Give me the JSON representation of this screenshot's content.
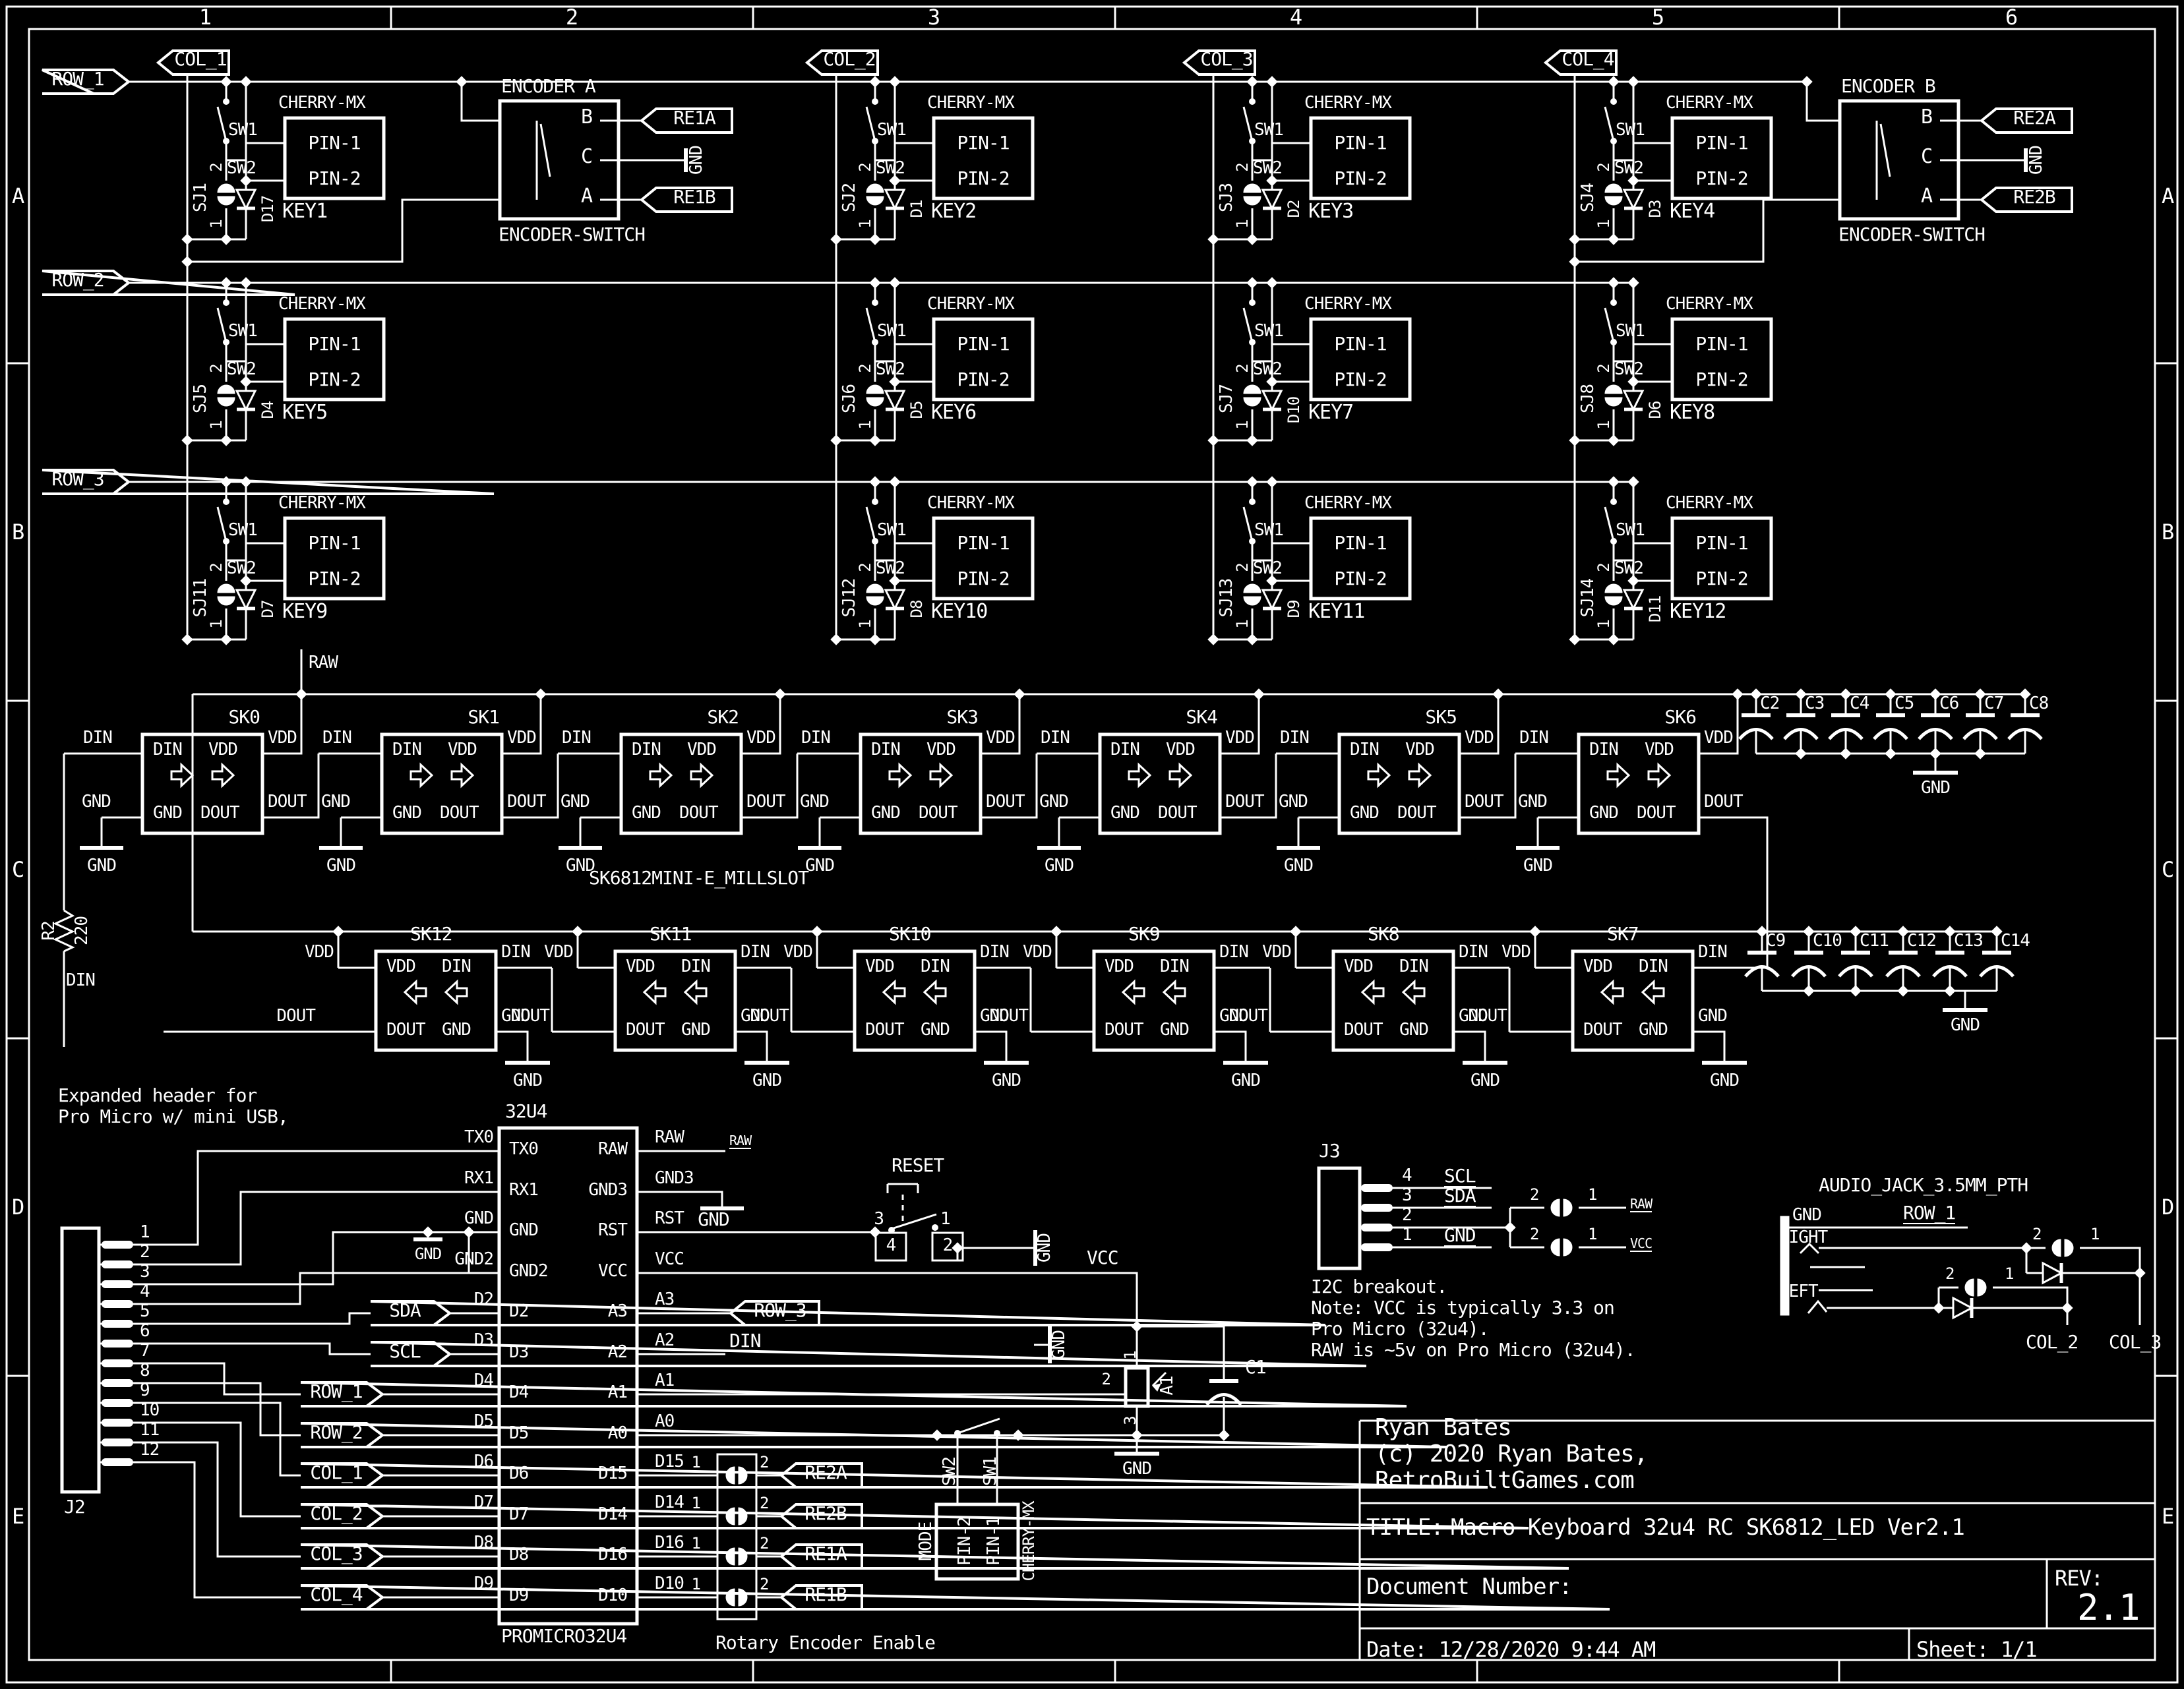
{
  "sheet": {
    "cols": [
      "1",
      "2",
      "3",
      "4",
      "5",
      "6"
    ],
    "rows": [
      "A",
      "B",
      "C",
      "D",
      "E"
    ]
  },
  "title_block": {
    "owner": [
      "Ryan Bates",
      "(c) 2020 Ryan Bates,",
      "RetroBuiltGames.com"
    ],
    "title_label": "TITLE:",
    "title": "Macro Keyboard 32u4 RC SK6812_LED Ver2.1",
    "doc_label": "Document Number:",
    "rev_label": "REV:",
    "rev": "2.1",
    "date_label": "Date: 12/28/2020 9:44 AM",
    "sheet_label": "Sheet: 1/1"
  },
  "nets": {
    "rows": [
      "ROW_1",
      "ROW_2",
      "ROW_3"
    ],
    "cols": [
      "COL_1",
      "COL_2",
      "COL_3",
      "COL_4"
    ],
    "raw": "RAW",
    "vcc": "VCC",
    "gnd": "GND",
    "din": "DIN",
    "sda": "SDA",
    "scl": "SCL"
  },
  "matrix": {
    "switch_part": "CHERRY-MX",
    "sw1": "SW1",
    "sw2": "SW2",
    "pin1": "PIN-1",
    "pin2": "PIN-2",
    "jp_top": "2",
    "jp_bot": "1",
    "keys": [
      {
        "key": "KEY1",
        "sj": "SJ1",
        "d": "D17"
      },
      {
        "key": "KEY2",
        "sj": "SJ2",
        "d": "D1"
      },
      {
        "key": "KEY3",
        "sj": "SJ3",
        "d": "D2"
      },
      {
        "key": "KEY4",
        "sj": "SJ4",
        "d": "D3"
      },
      {
        "key": "KEY5",
        "sj": "SJ5",
        "d": "D4"
      },
      {
        "key": "KEY6",
        "sj": "SJ6",
        "d": "D5"
      },
      {
        "key": "KEY7",
        "sj": "SJ7",
        "d": "D10"
      },
      {
        "key": "KEY8",
        "sj": "SJ8",
        "d": "D6"
      },
      {
        "key": "KEY9",
        "sj": "SJ11",
        "d": "D7"
      },
      {
        "key": "KEY10",
        "sj": "SJ12",
        "d": "D8"
      },
      {
        "key": "KEY11",
        "sj": "SJ13",
        "d": "D9"
      },
      {
        "key": "KEY12",
        "sj": "SJ14",
        "d": "D11"
      }
    ]
  },
  "encoders": [
    {
      "name": "ENCODER A",
      "part": "ENCODER-SWITCH",
      "pin_b": "B",
      "pin_c": "C",
      "pin_a": "A",
      "net_top": "RE1A",
      "net_mid": "GND",
      "net_bot": "RE1B"
    },
    {
      "name": "ENCODER B",
      "part": "ENCODER-SWITCH",
      "pin_b": "B",
      "pin_c": "C",
      "pin_a": "A",
      "net_top": "RE2A",
      "net_mid": "GND",
      "net_bot": "RE2B"
    }
  ],
  "leds": {
    "part": "SK6812MINI-E_MILLSLOT",
    "din": "DIN",
    "vdd": "VDD",
    "gnd": "GND",
    "dout": "DOUT",
    "top": [
      "SK0",
      "SK1",
      "SK2",
      "SK3",
      "SK4",
      "SK5",
      "SK6"
    ],
    "bottom": [
      "SK12",
      "SK11",
      "SK10",
      "SK9",
      "SK8",
      "SK7"
    ],
    "caps_top": [
      "C2",
      "C3",
      "C4",
      "C5",
      "C6",
      "C7",
      "C8"
    ],
    "caps_bottom": [
      "C9",
      "C10",
      "C11",
      "C12",
      "C13",
      "C14"
    ]
  },
  "resistor": {
    "ref": "R2",
    "value": "220"
  },
  "micro": {
    "note": [
      "Expanded header for",
      "Pro Micro w/ mini USB,"
    ],
    "ref": "32U4",
    "part": "PROMICRO32U4",
    "left_pins": [
      "TX0",
      "RX1",
      "GND",
      "GND2",
      "D2",
      "D3",
      "D4",
      "D5",
      "D6",
      "D7",
      "D8",
      "D9"
    ],
    "right_pins": [
      "RAW",
      "GND3",
      "RST",
      "VCC",
      "A3",
      "A2",
      "A1",
      "A0",
      "D15",
      "D14",
      "D16",
      "D10"
    ],
    "j2": "J2",
    "j2_pins": [
      "1",
      "2",
      "3",
      "4",
      "5",
      "6",
      "7",
      "8",
      "9",
      "10",
      "11",
      "12"
    ],
    "reset": {
      "label": "RESET",
      "p3": "3",
      "p4": "4",
      "p1": "1",
      "p2": "2"
    },
    "pot": {
      "ref": "A1",
      "p1": "1",
      "p2": "2",
      "p3": "3"
    },
    "cap": "C1",
    "re_rows": [
      {
        "pin": "D15",
        "n1": "1",
        "n2": "2",
        "net": "RE2A"
      },
      {
        "pin": "D14",
        "n1": "1",
        "n2": "2",
        "net": "RE2B"
      },
      {
        "pin": "D16",
        "n1": "1",
        "n2": "2",
        "net": "RE1A"
      },
      {
        "pin": "D10",
        "n1": "1",
        "n2": "2",
        "net": "RE1B"
      }
    ],
    "rotary_note": "Rotary Encoder Enable",
    "mode": {
      "label": "MODE",
      "sw2": "SW2",
      "sw1": "SW1",
      "pin2": "PIN-2",
      "pin1": "PIN-1",
      "part": "CHERRY-MX"
    }
  },
  "i2c": {
    "ref": "J3",
    "pins": [
      {
        "n": "4",
        "net": "SCL"
      },
      {
        "n": "3",
        "net": "SDA"
      },
      {
        "n": "2",
        "net": ""
      },
      {
        "n": "1",
        "net": "GND"
      }
    ],
    "jl": "2",
    "jr": "1",
    "net_raw": "RAW",
    "net_vcc": "VCC",
    "note": [
      "I2C breakout.",
      "Note: VCC is typically 3.3 on",
      "Pro Micro (32u4).",
      "RAW is ~5v on Pro Micro (32u4)."
    ]
  },
  "audio": {
    "part": "AUDIO_JACK_3.5MM_PTH",
    "gnd": "GND",
    "right": "RIGHT",
    "left": "LEFT",
    "row_net": "ROW_1",
    "col2": "COL_2",
    "col3": "COL_3",
    "jl": "2",
    "jr": "1"
  }
}
